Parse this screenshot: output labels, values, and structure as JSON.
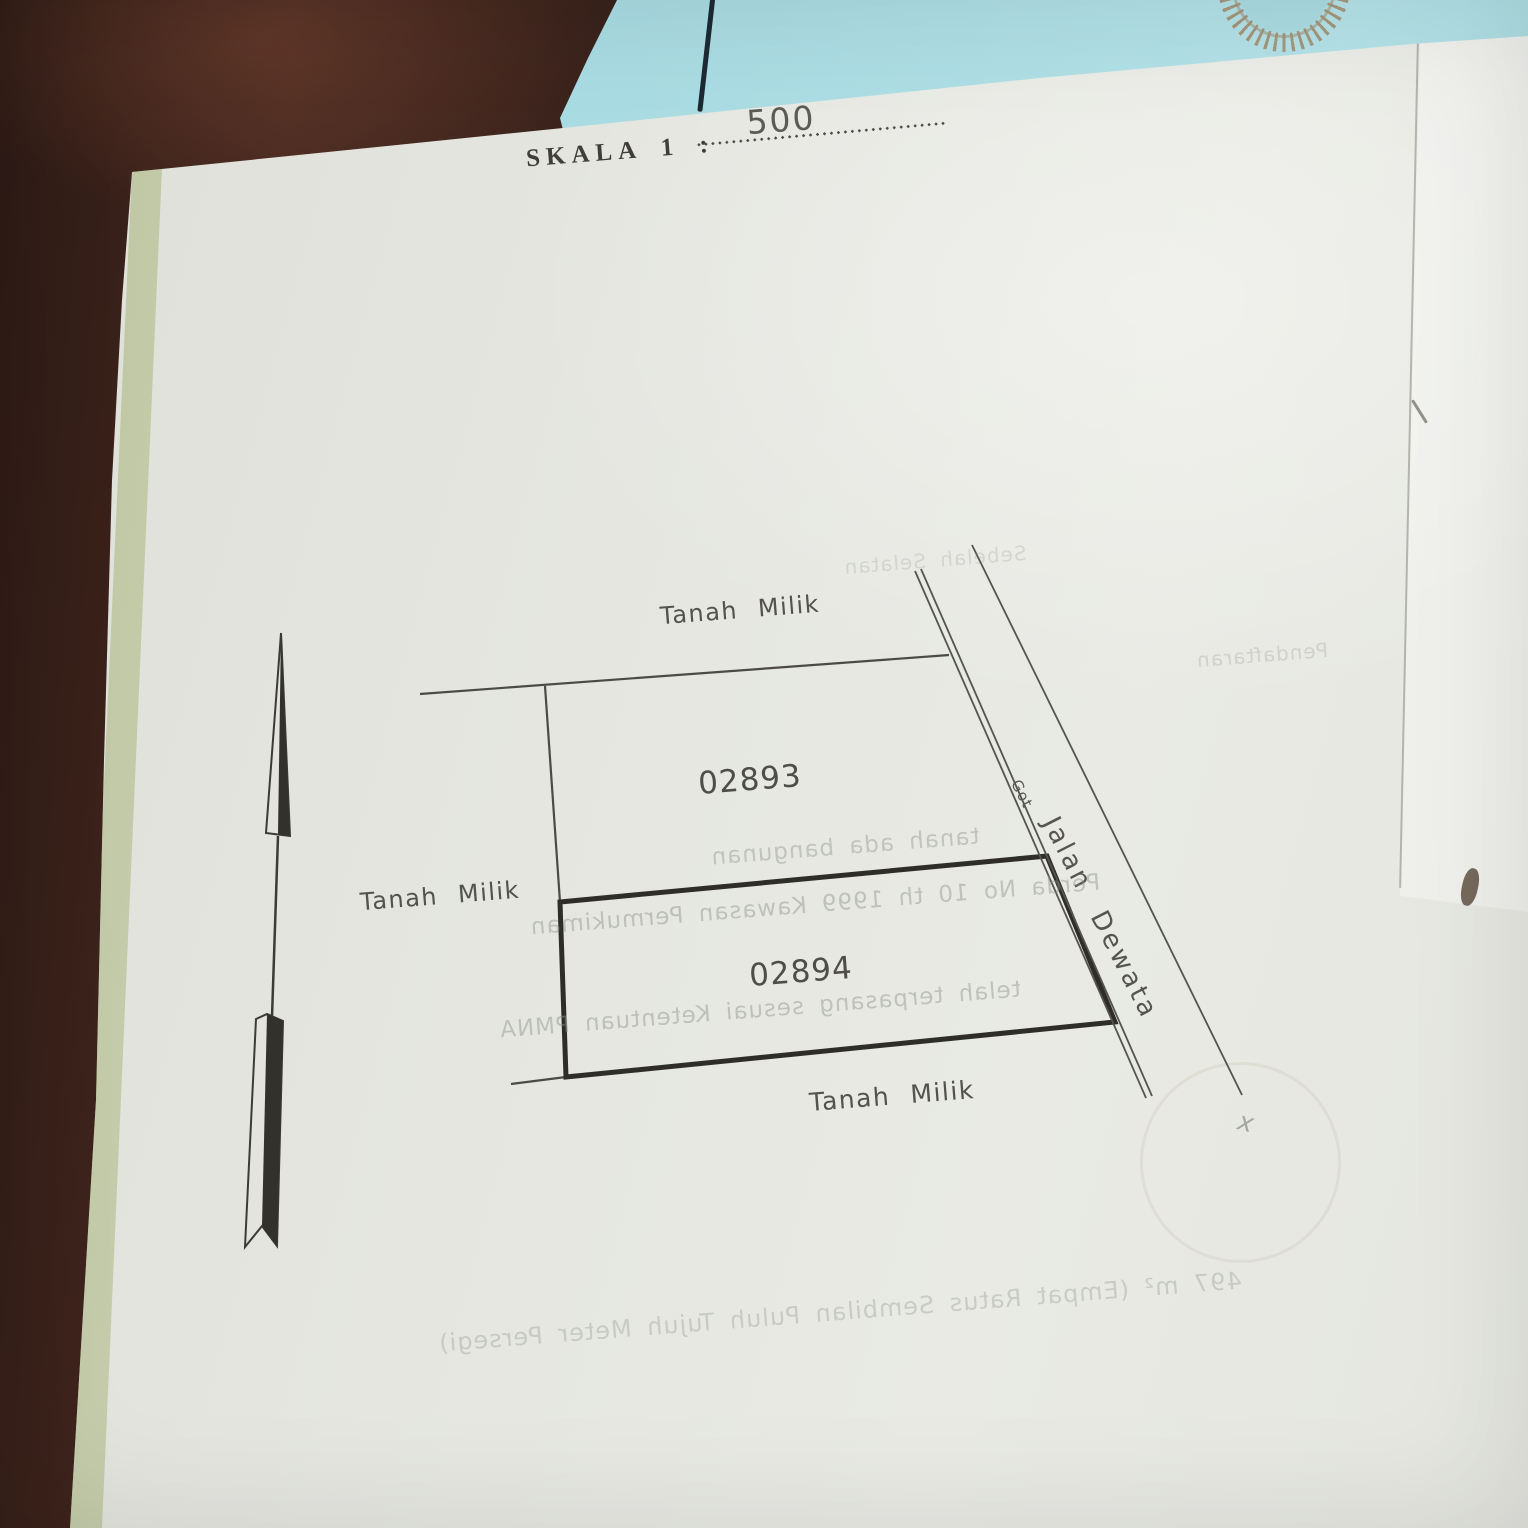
{
  "document": {
    "scale_label": "SKALA 1 :",
    "scale_value": "500"
  },
  "plan": {
    "adjacent_top": "Tanah Milik",
    "adjacent_left": "Tanah Milik",
    "adjacent_bottom": "Tanah Milik",
    "parcel_upper_number": "02893",
    "parcel_lower_number": "02894",
    "road_name": "Jalan Dewata",
    "drain_label": "Got"
  },
  "ghost_texts": {
    "line1": "tanah ada bangunan",
    "line2": "Perda No 10 th 1999 Kawasan Permukiman",
    "line3": "telah terpasang sesuai Ketentuan PMNA",
    "line4": "497 m² (Empat Ratus Sembilan Puluh Tujuh Meter Persegi)",
    "line5": "Pendaftaran",
    "line6": "Sebelah Selatan",
    "hand_mark": "x"
  },
  "colors": {
    "wood_table": "#3a231d",
    "blue_paper": "#a9dbe2",
    "page": "#e5e6e0",
    "ink": "#4b4a45",
    "bold_parcel_line": "#2e2d2a",
    "ghost_text": "#8d938b",
    "emblem": "#9e805c"
  }
}
